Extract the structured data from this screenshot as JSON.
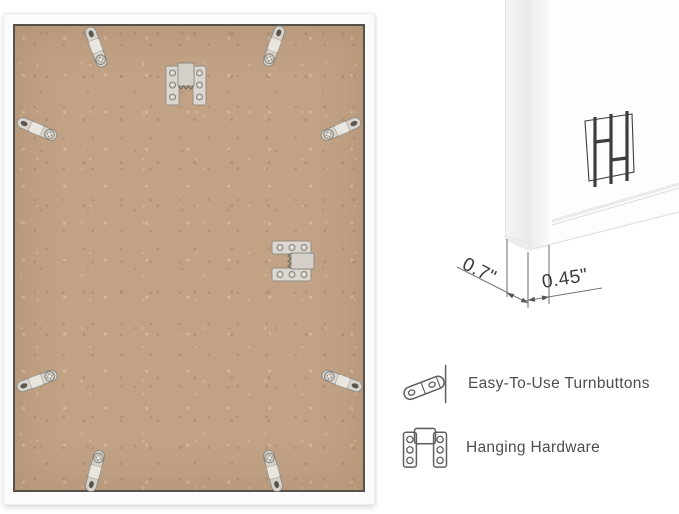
{
  "dimensions": {
    "depth_label": "0.7\"",
    "face_width_label": "0.45\""
  },
  "features": [
    {
      "icon": "turnbutton-icon",
      "label": "Easy-To-Use Turnbuttons"
    },
    {
      "icon": "hanging-hardware-icon",
      "label": "Hanging Hardware"
    }
  ],
  "graphics": {
    "frame_back": {
      "turnbuttons": 8,
      "sawtooth_hangers": 2,
      "backing": "mdf-board"
    },
    "corner_profile": {
      "brand_logo": "double-h-monogram"
    }
  },
  "colors": {
    "background": "#ffffff",
    "mdf_board": "#c1a285",
    "mdf_edge": "#56514a",
    "frame_white": "#fbfbfb",
    "metal": "#d8d4cd",
    "label_text": "#4d4d4d",
    "dimension_text": "#3a3a3a",
    "dimension_line": "#777777",
    "logo": "#3d3d3d",
    "icon_stroke": "#5f5f5f"
  }
}
